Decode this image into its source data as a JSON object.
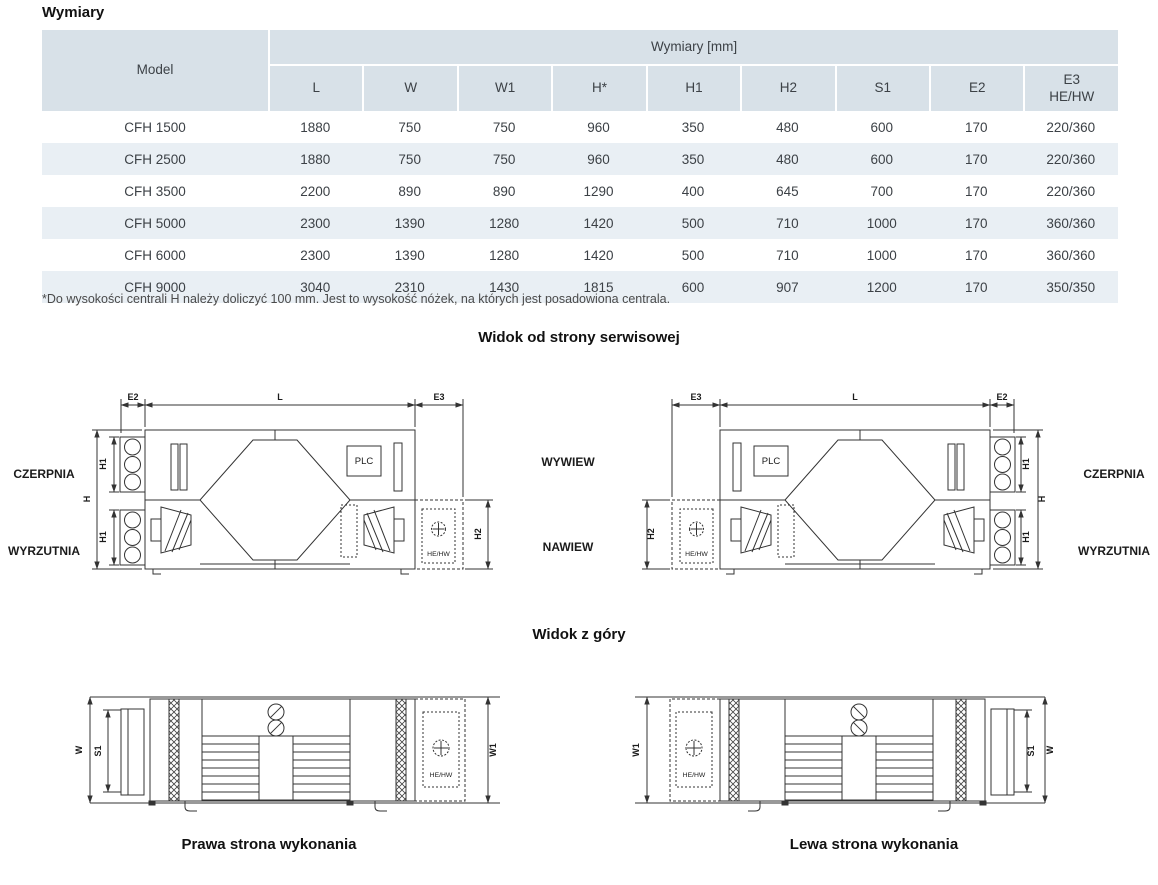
{
  "title": "Wymiary",
  "table": {
    "model_header": "Model",
    "group_header": "Wymiary [mm]",
    "columns": [
      "L",
      "W",
      "W1",
      "H*",
      "H1",
      "H2",
      "S1",
      "E2",
      "E3\nHE/HW"
    ],
    "rows": [
      {
        "model": "CFH 1500",
        "values": [
          "1880",
          "750",
          "750",
          "960",
          "350",
          "480",
          "600",
          "170",
          "220/360"
        ]
      },
      {
        "model": "CFH 2500",
        "values": [
          "1880",
          "750",
          "750",
          "960",
          "350",
          "480",
          "600",
          "170",
          "220/360"
        ]
      },
      {
        "model": "CFH 3500",
        "values": [
          "2200",
          "890",
          "890",
          "1290",
          "400",
          "645",
          "700",
          "170",
          "220/360"
        ]
      },
      {
        "model": "CFH 5000",
        "values": [
          "2300",
          "1390",
          "1280",
          "1420",
          "500",
          "710",
          "1000",
          "170",
          "360/360"
        ]
      },
      {
        "model": "CFH 6000",
        "values": [
          "2300",
          "1390",
          "1280",
          "1420",
          "500",
          "710",
          "1000",
          "170",
          "360/360"
        ]
      },
      {
        "model": "CFH 9000",
        "values": [
          "3040",
          "2310",
          "1430",
          "1815",
          "600",
          "907",
          "1200",
          "170",
          "350/350"
        ]
      }
    ]
  },
  "footnote": "*Do wysokości centrali H należy doliczyć 100 mm. Jest to wysokość nóżek, na których jest posadowiona centrala.",
  "headings": {
    "service_view": "Widok od strony serwisowej",
    "top_view": "Widok z góry"
  },
  "captions": {
    "right_side": "Prawa strona wykonania",
    "left_side": "Lewa strona wykonania"
  },
  "diagram_labels": {
    "E2": "E2",
    "L": "L",
    "E3": "E3",
    "H": "H",
    "H1": "H1",
    "H2": "H2",
    "W": "W",
    "S1": "S1",
    "W1": "W1",
    "plc": "PLC",
    "he_hw": "HE/HW",
    "czerpnia": "CZERPNIA",
    "wyrzutnia": "WYRZUTNIA",
    "wywiew": "WYWIEW",
    "nawiew": "NAWIEW"
  },
  "colors": {
    "table_header_bg": "#d8e1e8",
    "table_row_alt_bg": "#e9eff4",
    "diagram_line": "#333333"
  }
}
